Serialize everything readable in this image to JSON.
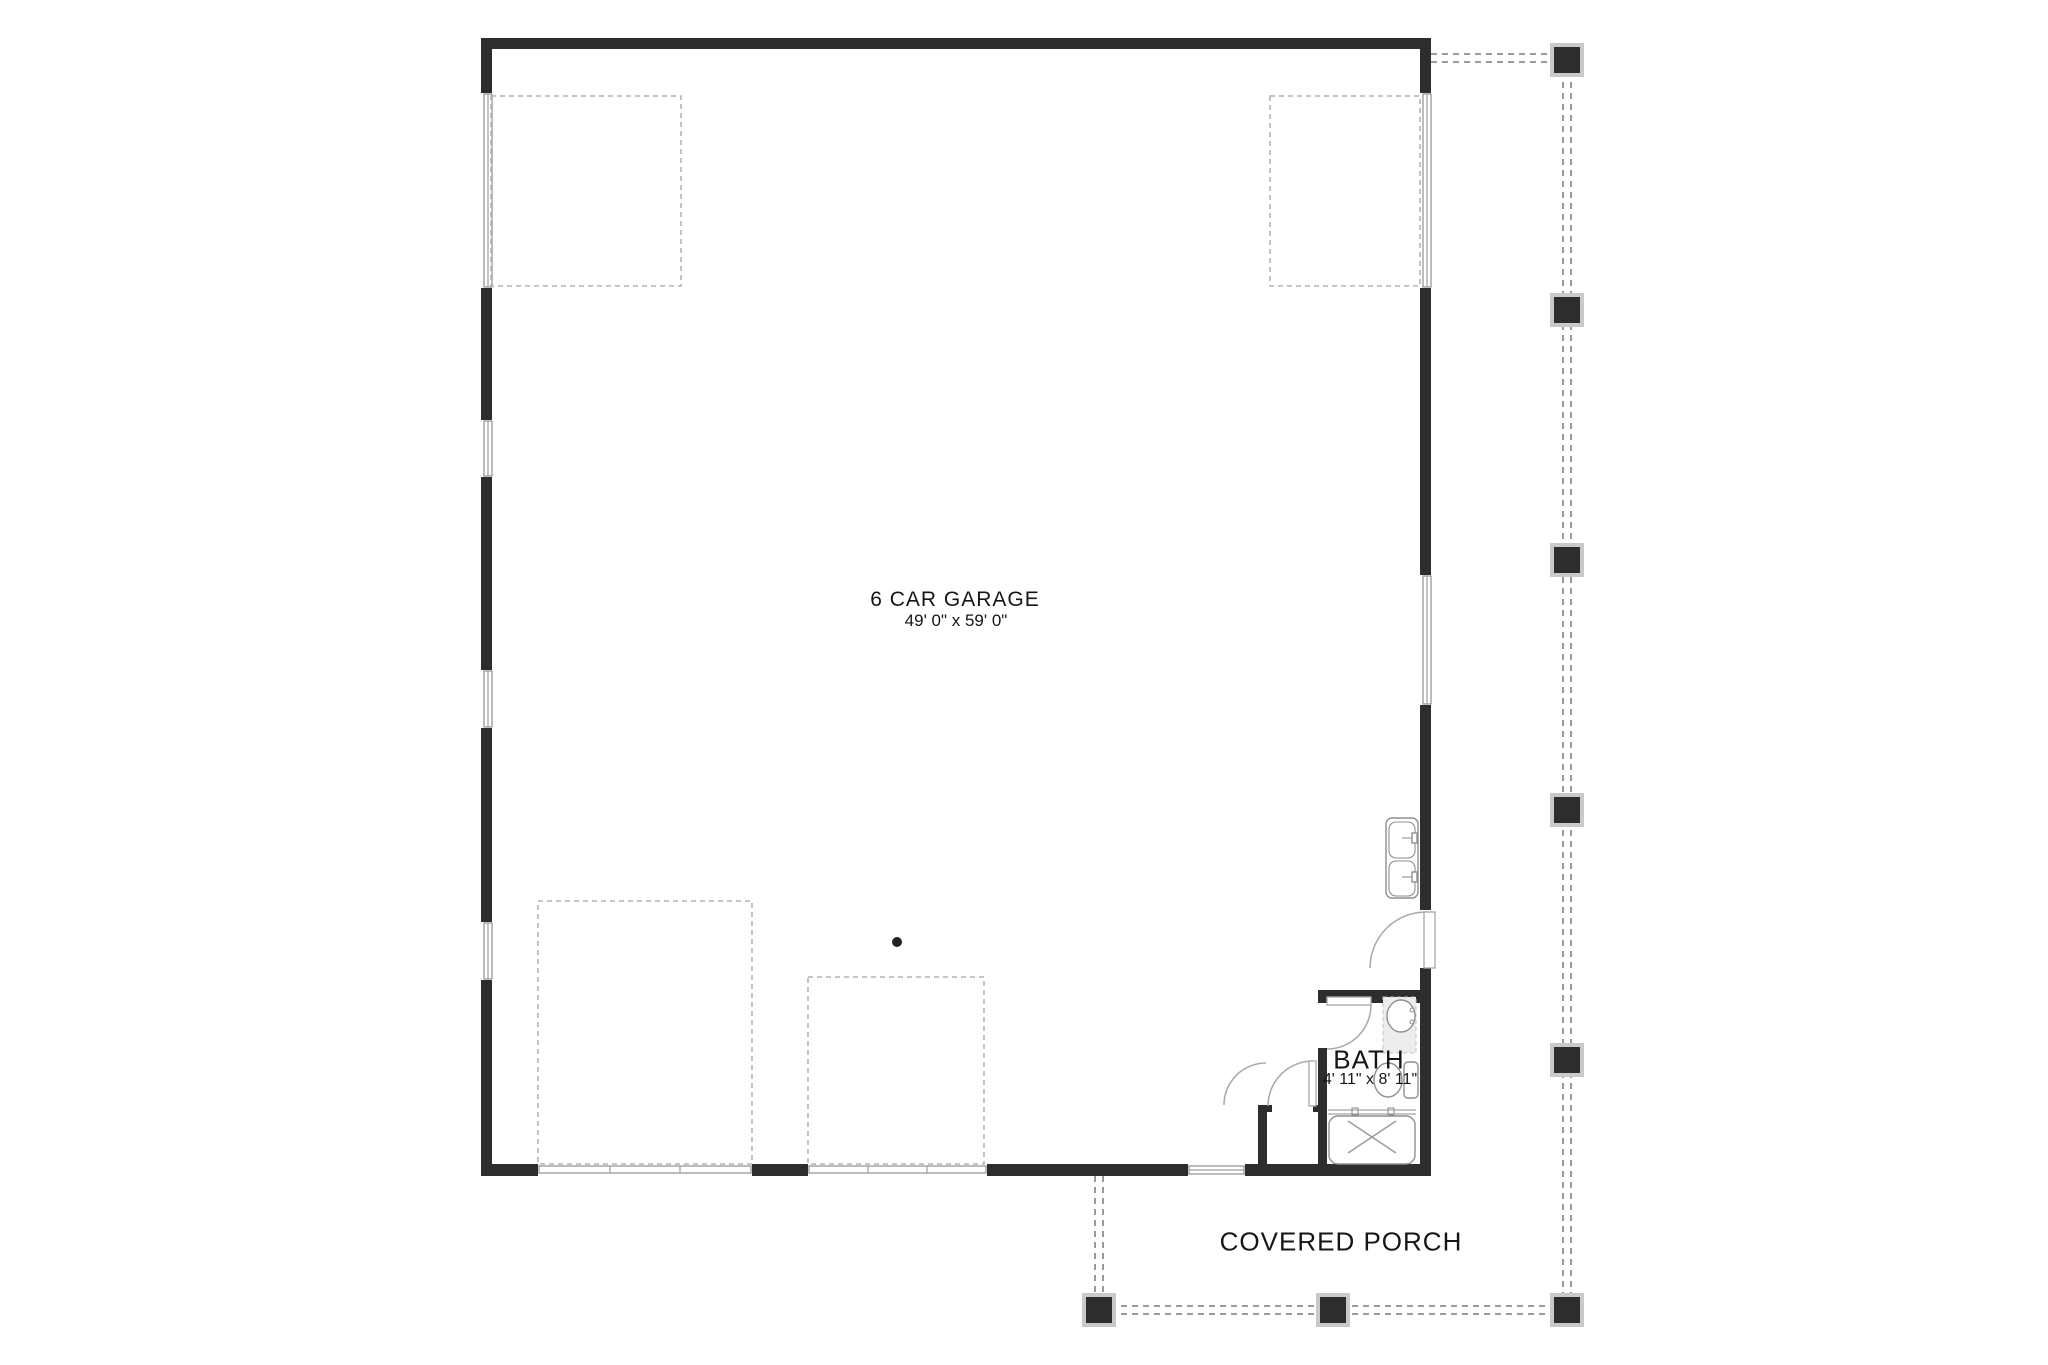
{
  "rooms": {
    "garage": {
      "name": "6 CAR GARAGE",
      "size": "49' 0\" x 59' 0\""
    },
    "bath": {
      "name": "BATH",
      "size": "4' 11\" x 8' 11\""
    },
    "porch": {
      "name": "COVERED PORCH"
    }
  },
  "colors": {
    "wall": "#2d2d2d",
    "dash": "#b4b4b4",
    "porch-dash": "#9a9a9a",
    "fixture": "#8f8f8f",
    "arc": "#a8a8a8",
    "text": "#161616",
    "post-border": "#c9c9c9",
    "bg": "#ffffff",
    "glass": "#9c9c9c"
  }
}
